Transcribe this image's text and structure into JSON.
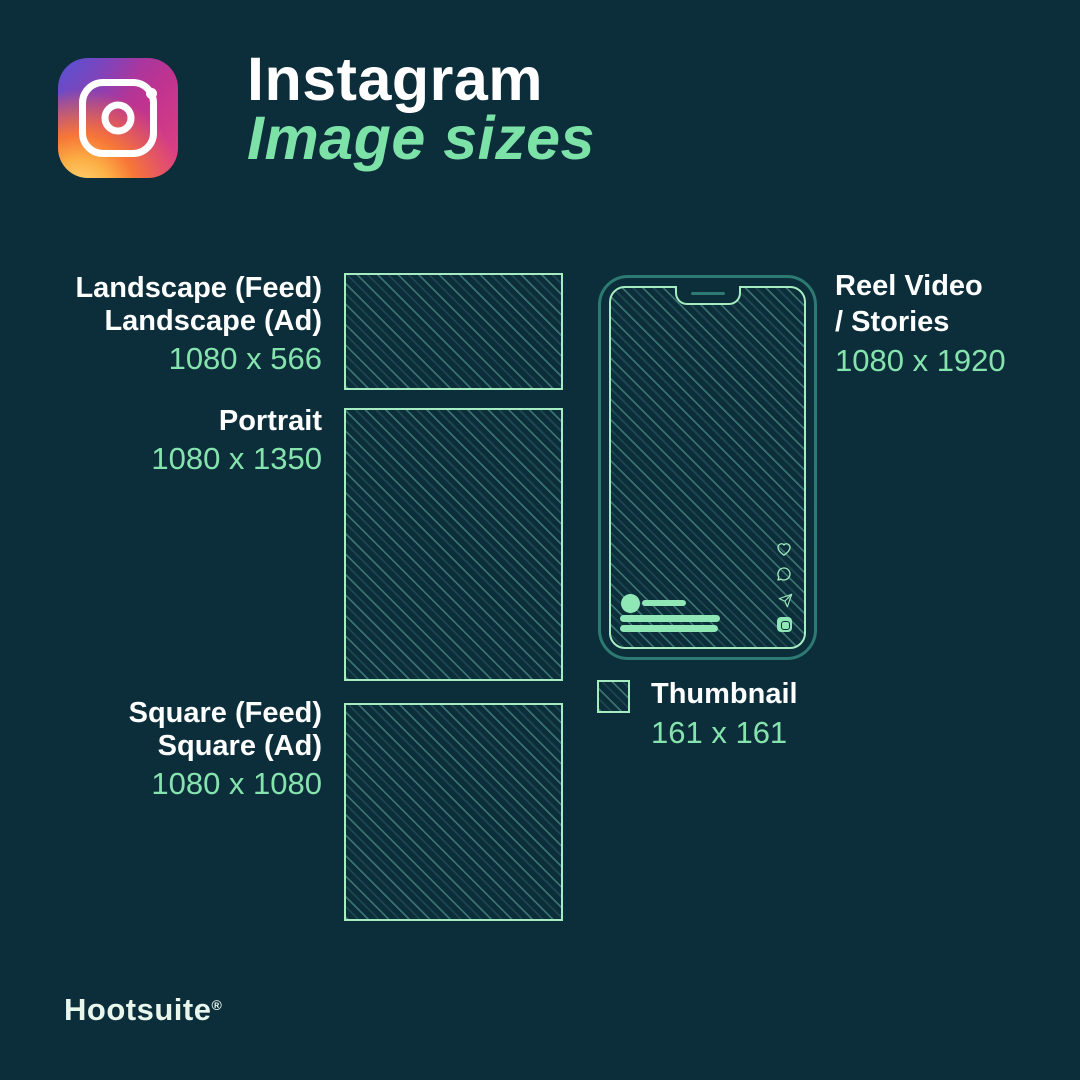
{
  "header": {
    "title": "Instagram",
    "subtitle": "Image sizes"
  },
  "sizes": [
    {
      "name": "landscape",
      "labels": [
        "Landscape (Feed)",
        "Landscape (Ad)"
      ],
      "dimensions": "1080 x 566"
    },
    {
      "name": "portrait",
      "labels": [
        "Portrait"
      ],
      "dimensions": "1080 x 1350"
    },
    {
      "name": "square",
      "labels": [
        "Square (Feed)",
        "Square (Ad)"
      ],
      "dimensions": "1080 x 1080"
    },
    {
      "name": "reel",
      "labels": [
        "Reel Video",
        "/ Stories"
      ],
      "dimensions": "1080 x 1920"
    },
    {
      "name": "thumbnail",
      "labels": [
        "Thumbnail"
      ],
      "dimensions": "161 x 161"
    }
  ],
  "footer": {
    "brand": "Hootsuite",
    "registered": "®"
  },
  "icons": {
    "logo": "instagram-logo",
    "heart": "heart-icon",
    "comment": "comment-icon",
    "share": "paper-plane-icon",
    "audio": "audio-tile-icon",
    "speaker": "speaker-notch"
  },
  "colors": {
    "background": "#0C2D3A",
    "label_white": "#FDFEFE",
    "accent_green": "#85E4AD",
    "title_green": "#7CE2A7",
    "outline_green": "#A6ECC1",
    "hatch_teal": "#2F6F75",
    "phone_body_teal": "#2C7A72",
    "footer_mint": "#E8F6EC"
  }
}
